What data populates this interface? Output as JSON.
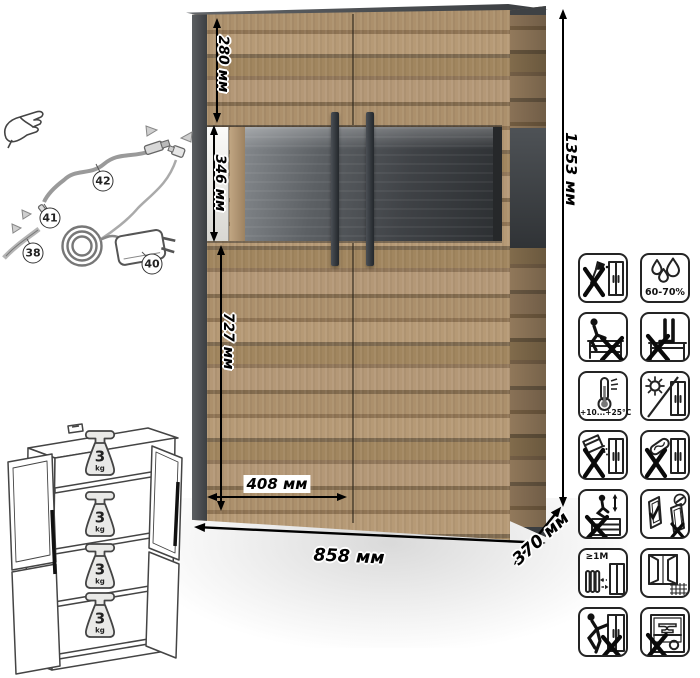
{
  "colors": {
    "wood_light": "#b69a76",
    "wood_dark": "#8a7254",
    "frame_dark": "#44474a",
    "glass_back": "#3a3d40",
    "background": "#ffffff"
  },
  "dimensions": {
    "total_height": "1353 мм",
    "total_width": "858 мм",
    "depth": "370 мм",
    "top_section_height": "280 мм",
    "display_section_height": "346 мм",
    "bottom_section_height": "727 мм",
    "door_width": "408 мм"
  },
  "lighting_kit": {
    "parts": [
      {
        "id": "38"
      },
      {
        "id": "40"
      },
      {
        "id": "41"
      },
      {
        "id": "42"
      }
    ]
  },
  "shelf_load": {
    "shelves": [
      {
        "value": "3",
        "unit": "kg"
      },
      {
        "value": "3",
        "unit": "kg"
      },
      {
        "value": "3",
        "unit": "kg"
      },
      {
        "value": "3",
        "unit": "kg"
      }
    ]
  },
  "care_icons": [
    {
      "name": "no-sharp-tools"
    },
    {
      "name": "humidity-range",
      "label": "60-70%"
    },
    {
      "name": "no-sitting-on-furniture"
    },
    {
      "name": "no-standing-on-furniture"
    },
    {
      "name": "temperature-range",
      "label": "+10...+25°C"
    },
    {
      "name": "avoid-direct-sunlight"
    },
    {
      "name": "no-abrasive-cleaners"
    },
    {
      "name": "no-scouring-pads"
    },
    {
      "name": "no-jumping-on-furniture"
    },
    {
      "name": "door-adjustment-allowed"
    },
    {
      "name": "keep-1m-from-heat",
      "label": "≥1M"
    },
    {
      "name": "ventilate-room"
    },
    {
      "name": "no-dragging"
    },
    {
      "name": "no-heavy-objects-inside"
    }
  ]
}
